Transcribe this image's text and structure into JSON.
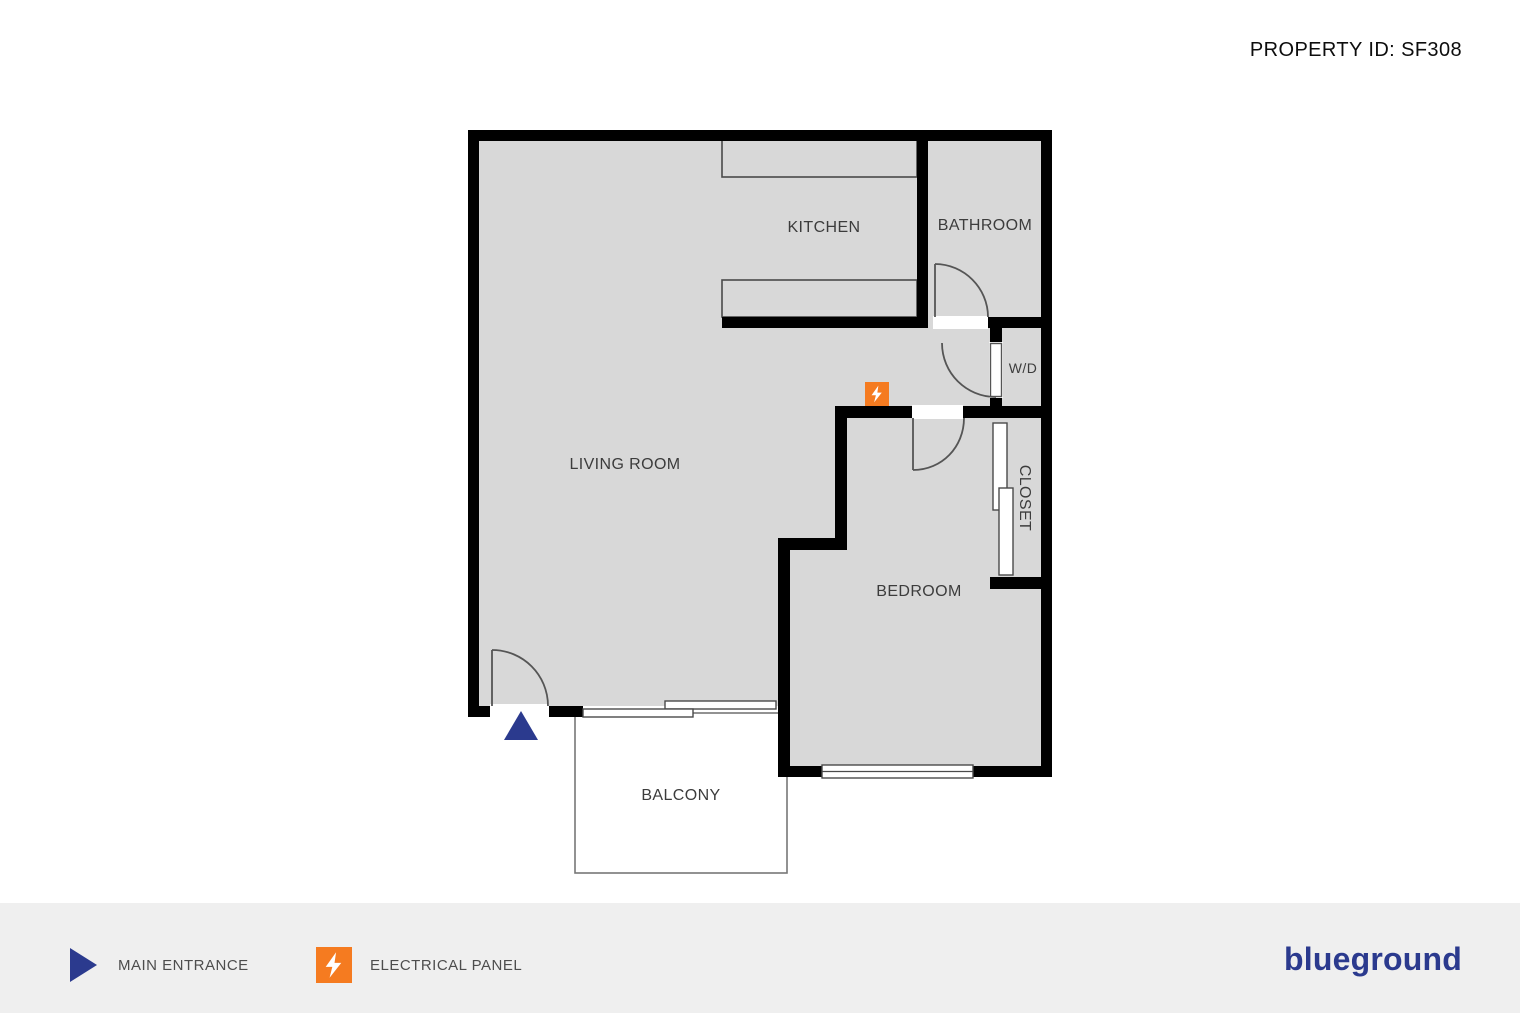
{
  "header": {
    "property_id": "PROPERTY ID: SF308"
  },
  "floorplan": {
    "labels": {
      "living_room": "LIVING ROOM",
      "kitchen": "KITCHEN",
      "bathroom": "BATHROOM",
      "wd": "W/D",
      "closet": "CLOSET",
      "bedroom": "BEDROOM",
      "balcony": "BALCONY"
    },
    "markers": {
      "main_entrance": "main-entrance-triangle",
      "electrical_panel": "electrical-panel-square"
    }
  },
  "legend": {
    "items": [
      {
        "icon": "main-entrance-icon",
        "label": "MAIN ENTRANCE"
      },
      {
        "icon": "electrical-panel-icon",
        "label": "ELECTRICAL PANEL"
      }
    ]
  },
  "footer": {
    "brand": "blueground"
  },
  "colors": {
    "wall": "#000000",
    "floor": "#d8d8d8",
    "accent_blue": "#2b3a8e",
    "accent_orange": "#f57b20",
    "footer_bg": "#efefef",
    "label_gray": "#4d4d4d",
    "line_gray": "#555555"
  }
}
